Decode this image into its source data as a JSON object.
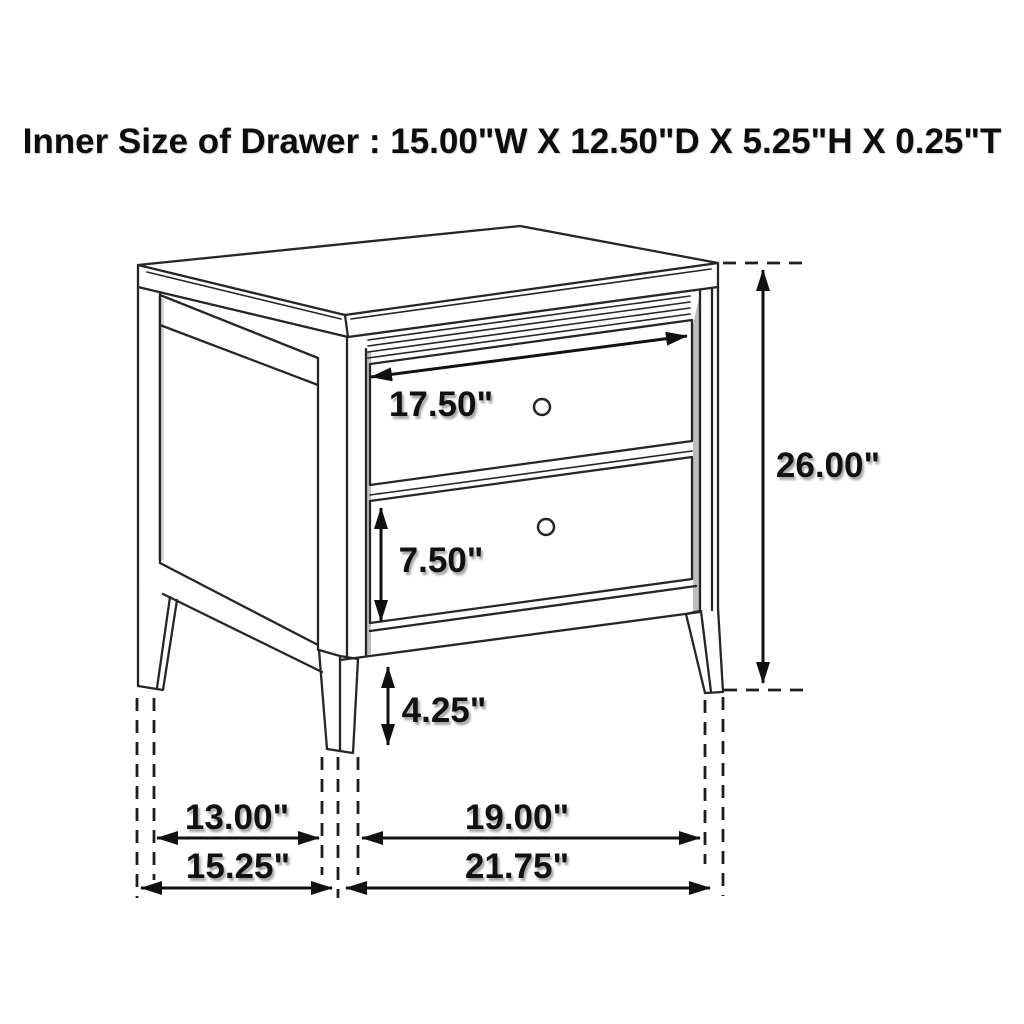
{
  "title": "Inner Size of Drawer : 15.00\"W X 12.50\"D X 5.25\"H X 0.25\"T",
  "figure": {
    "type": "furniture-dimension-diagram",
    "subject": "Two-drawer nightstand line drawing",
    "colors": {
      "line": "#262626",
      "label": "#111111",
      "background": "#ffffff",
      "shading": "#bdbdbd"
    },
    "labels": {
      "drawer_width": "17.50\"",
      "overall_height": "26.00\"",
      "lower_drawer_height": "7.50\"",
      "leg_height": "4.25\"",
      "side_leg_spacing": "13.00\"",
      "front_leg_spacing": "19.00\"",
      "side_overall_depth": "15.25\"",
      "front_overall_width": "21.75\""
    }
  }
}
